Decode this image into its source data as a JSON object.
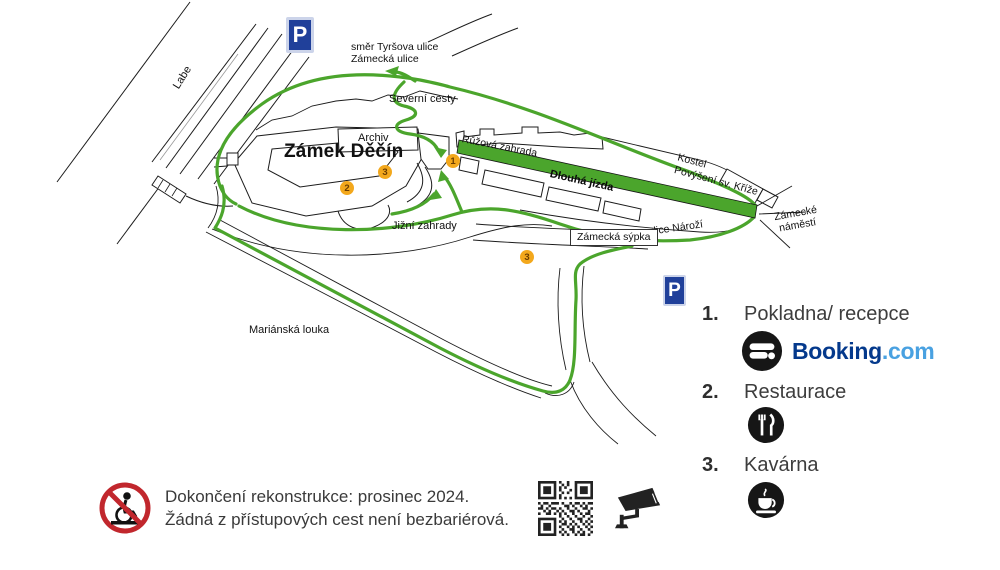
{
  "map": {
    "labels": {
      "labe": "Labe",
      "smer_line1": "směr Tyršova ulice",
      "smer_line2": "Zámecká ulice",
      "severni_cesty": "Severní cesty",
      "archiv": "Archiv",
      "zamek_decin": "Zámek Děčín",
      "ruzova_zahrada": "Růžová zahrada",
      "dlouha_jizda": "Dlouhá jízda",
      "kostel_line1": "Kostel",
      "kostel_line2": "Povýšení sv. Kříže",
      "zamecke_namesti_line1": "Zámecké",
      "zamecke_namesti_line2": "náměstí",
      "ulice_narozi": "ulice Nároží",
      "zamecka_sypka": "Zámecká sýpka",
      "jizni_zahrady": "Jižní zahrady",
      "marianska_louka": "Mariánská louka"
    },
    "parking_letter": "P",
    "markers": {
      "m1": "1",
      "m2": "2",
      "m3a": "3",
      "m3b": "3"
    },
    "colors": {
      "route_green": "#4ba52c",
      "parking_blue": "#20409a",
      "marker_orange": "#f3a81c"
    }
  },
  "legend": {
    "items": [
      {
        "num": "1.",
        "label": "Pokladna/ recepce"
      },
      {
        "num": "2.",
        "label": "Restaurace"
      },
      {
        "num": "3.",
        "label": "Kavárna"
      }
    ],
    "booking_text": "Booking",
    "booking_suffix": ".com",
    "booking_colors": {
      "navy": "#04398c",
      "blue": "#49a1e1"
    }
  },
  "footer": {
    "line1": "Dokončení rekonstrukce: prosinec 2024.",
    "line2": "Žádná z přístupových cest není bezbariérová."
  }
}
